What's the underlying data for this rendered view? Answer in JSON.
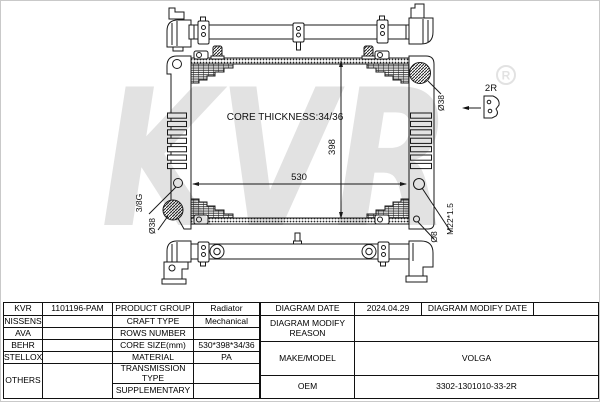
{
  "diagram": {
    "core_thickness_label": "CORE THICKNESS:34/36",
    "dim_width": "530",
    "dim_height": "398",
    "filler_diameter_label": "Ø38",
    "outlet_diameter_label": "Ø38",
    "drain_port_label": "3/8G",
    "mount_hole_label": "Ø8",
    "sensor_thread_label": "M22*1.5",
    "bracket_detail_label": "2R",
    "watermark_text": "KVR",
    "watermark_reg": "R"
  },
  "table": {
    "left": {
      "rows": [
        {
          "brand": "KVR",
          "code": "1101196-PAM",
          "property": "PRODUCT GROUP",
          "value": "Radiator"
        },
        {
          "brand": "NISSENS",
          "code": "",
          "property": "CRAFT TYPE",
          "value": "Mechanical"
        },
        {
          "brand": "AVA",
          "code": "",
          "property": "ROWS NUMBER",
          "value": ""
        },
        {
          "brand": "BEHR",
          "code": "",
          "property": "CORE SIZE(mm)",
          "value": "530*398*34/36"
        },
        {
          "brand": "STELLOX",
          "code": "",
          "property": "MATERIAL",
          "value": "PA"
        },
        {
          "brand": "OTHERS",
          "code": "",
          "property": "TRANSMISSION TYPE",
          "value": ""
        },
        {
          "property": "SUPPLEMENTARY",
          "value": ""
        }
      ]
    },
    "right": {
      "diagram_date_label": "DIAGRAM DATE",
      "diagram_date_value": "2024.04.29",
      "diagram_modify_date_label": "DIAGRAM MODIFY DATE",
      "diagram_modify_date_value": "",
      "diagram_modify_reason_label": "DIAGRAM MODIFY REASON",
      "diagram_modify_reason_value": "",
      "make_model_label": "MAKE/MODEL",
      "make_model_value": "VOLGA",
      "oem_label": "OEM",
      "oem_value": "3302-1301010-33-2R"
    }
  }
}
